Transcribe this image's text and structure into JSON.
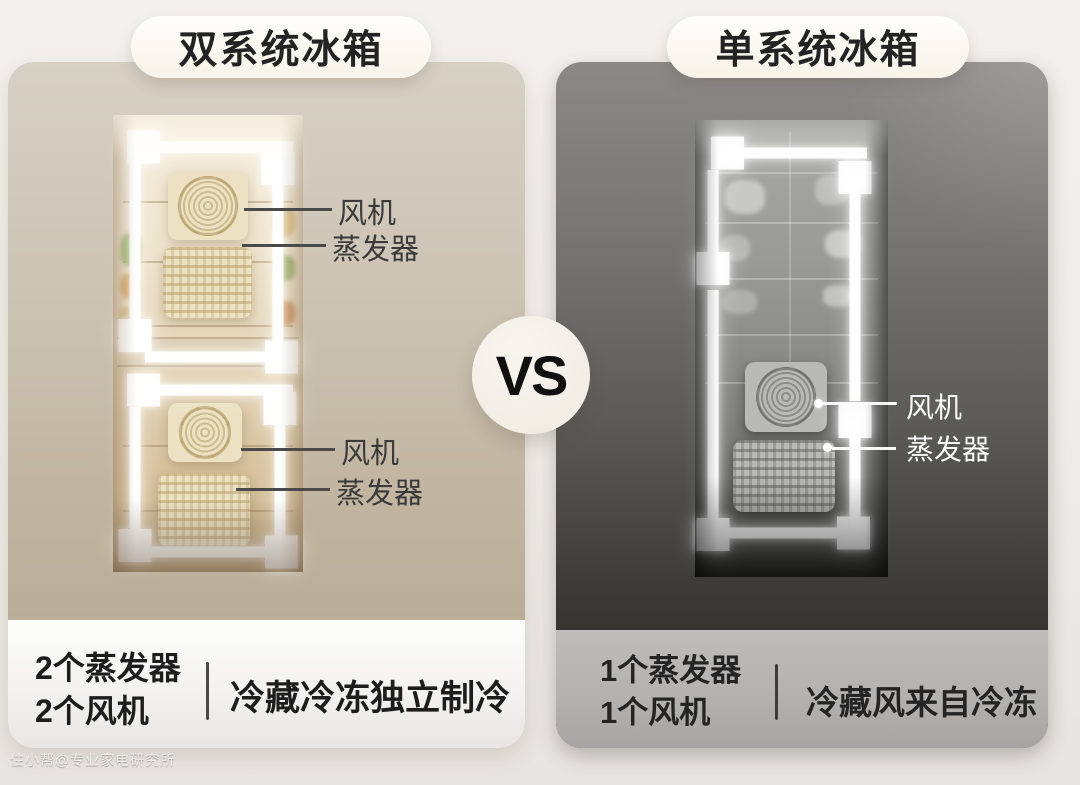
{
  "vs_badge": {
    "label": "VS"
  },
  "watermark": {
    "text": "住小帮@专业家电研究所"
  },
  "left_panel": {
    "title": "双系统冰箱",
    "callouts": {
      "fan_top": "风机",
      "evaporator_top": "蒸发器",
      "fan_bottom": "风机",
      "evaporator_bottom": "蒸发器"
    },
    "summary": {
      "count_line1": "2个蒸发器",
      "count_line2": "2个风机",
      "feature": "冷藏冷冻独立制冷"
    }
  },
  "right_panel": {
    "title": "单系统冰箱",
    "callouts": {
      "fan": "风机",
      "evaporator": "蒸发器"
    },
    "summary": {
      "count_line1": "1个蒸发器",
      "count_line2": "1个风机",
      "feature": "冷藏风来自冷冻"
    }
  },
  "colors": {
    "left_panel_bg": "#c2b6a2",
    "right_panel_bg": "#55544f",
    "pill_bg": "#fffdf7",
    "arrow": "#ffffff",
    "text_dark": "#1d1d1d",
    "text_light": "#fafafa"
  }
}
